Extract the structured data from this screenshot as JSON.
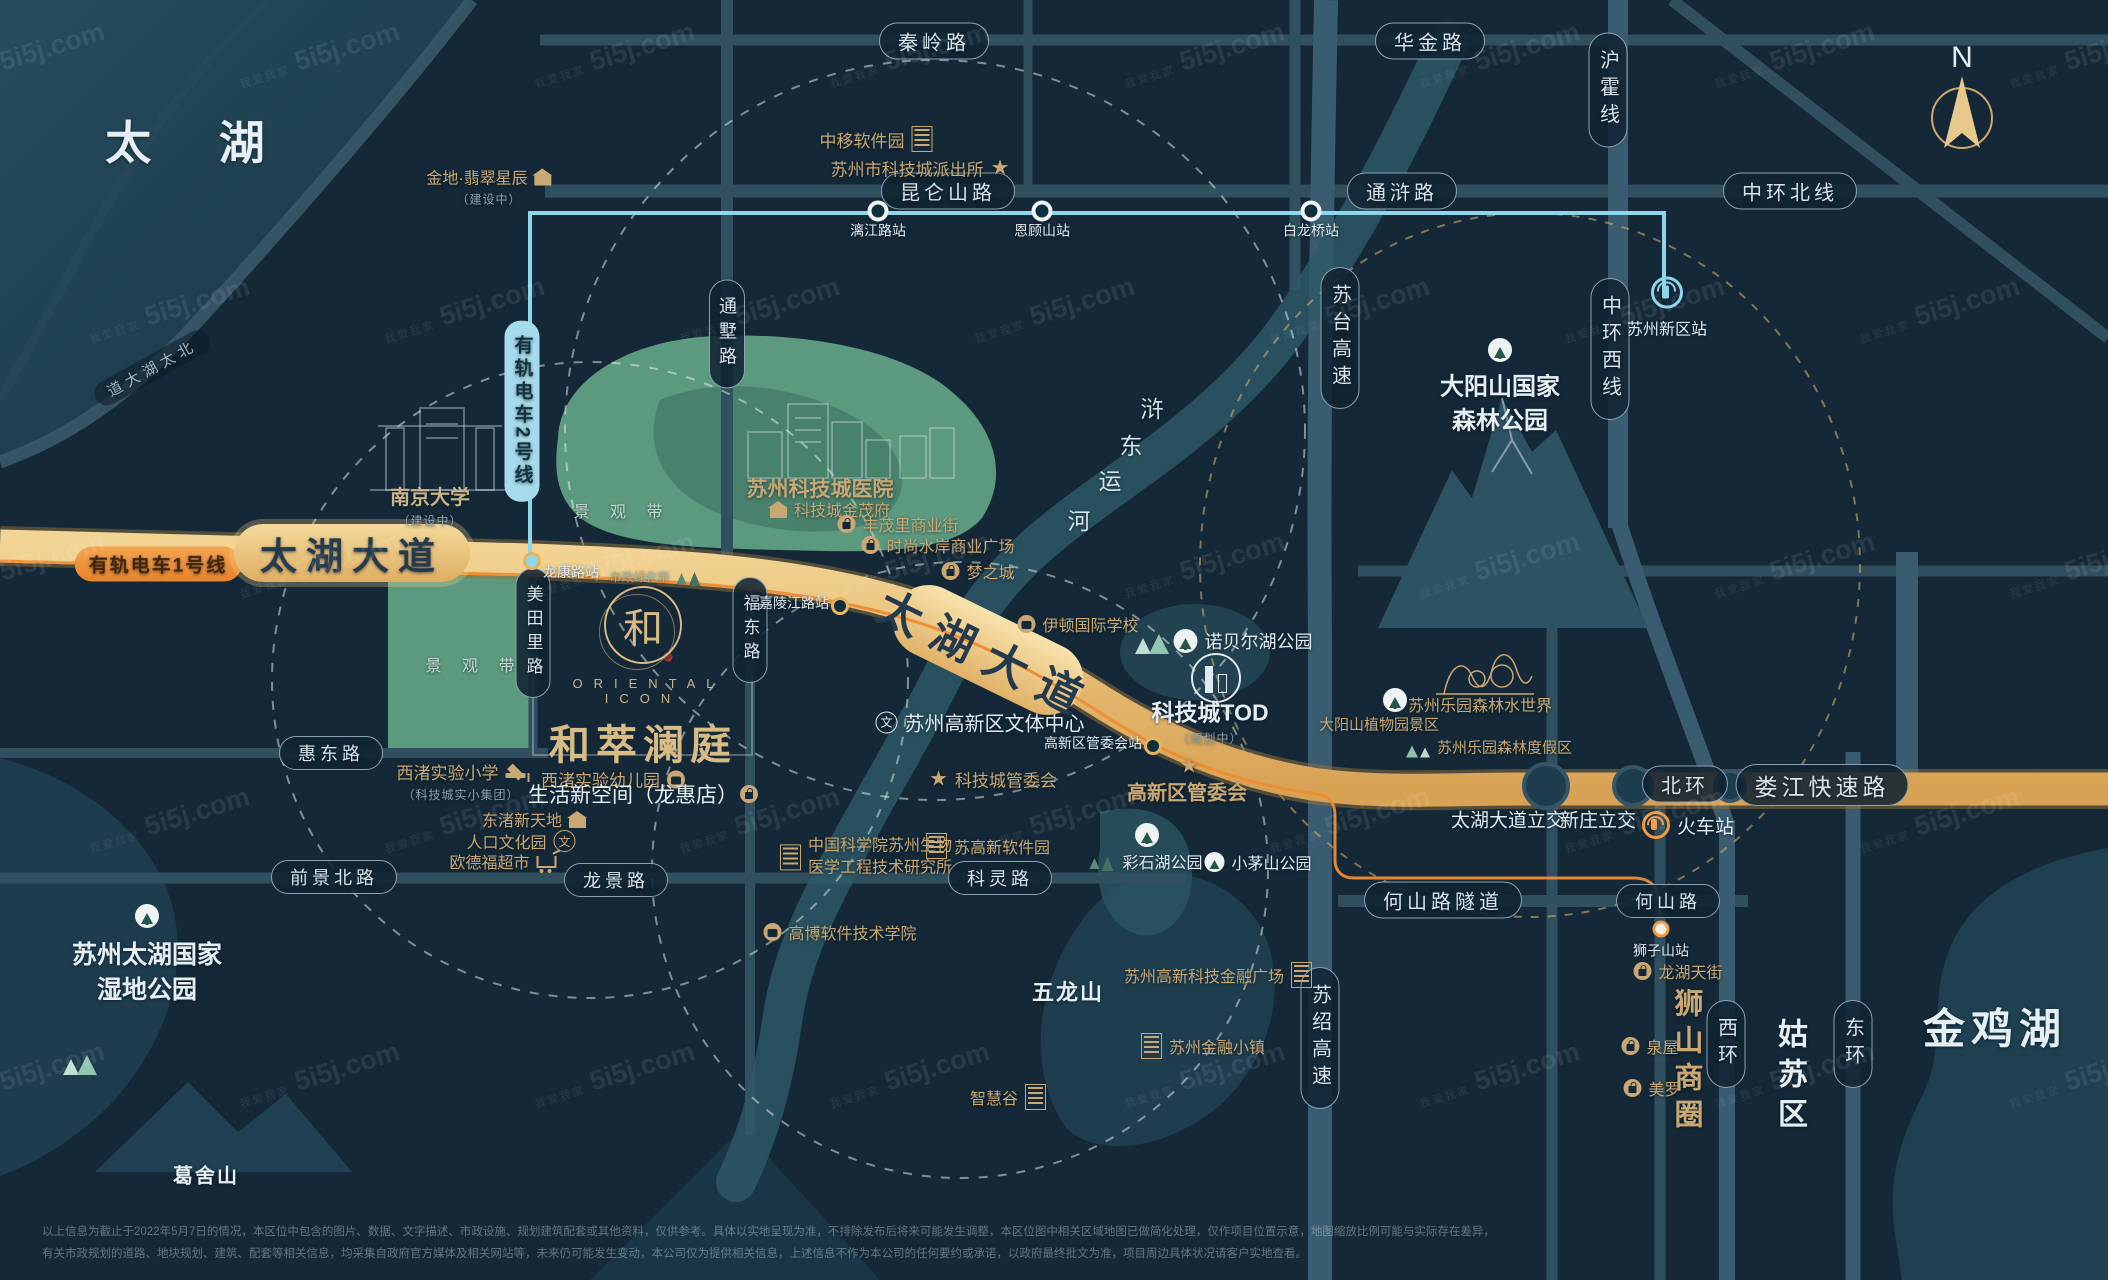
{
  "watermark": {
    "brand": "5i5j.com",
    "sub": "我爱我家"
  },
  "compass": {
    "n": "N"
  },
  "logo": {
    "mark": "和",
    "en": "ORIENTAL ICON",
    "name": "和萃澜庭",
    "tagline": "生活新空间（龙惠店）"
  },
  "disclaimer": {
    "line1": "以上信息为截止于2022年5月7日的情况，本区位中包含的图片、数据、文字描述、市政设施、规划建筑配套或其他资料，仅供参考。具体以实地呈现为准，不排除发布后将来可能发生调整，本区位图中相关区域地图已做简化处理，仅作项目位置示意，地图缩放比例可能与实际存在差异，",
    "line2": "有关市政规划的道路、地块规划、建筑、配套等相关信息，均采集自政府官方媒体及相关网站等，未来仍可能发生变动，本公司仅为提供相关信息，上述信息不作为本公司的任何要约或承诺，以政府最终批文为准，项目周边具体状况请客户实地查看。"
  },
  "labels": [
    {
      "name": "area-taihu",
      "type": "area",
      "text": "太  湖",
      "x": 192,
      "y": 140,
      "size": 46,
      "ls": 14
    },
    {
      "name": "area-jinjihu",
      "type": "area",
      "text": "金鸡湖",
      "x": 1995,
      "y": 1026,
      "size": 42,
      "ls": 6
    },
    {
      "name": "area-gusu",
      "type": "area-v",
      "text": "姑苏区",
      "x": 1789,
      "y": 1078,
      "size": 30,
      "ls": 10,
      "vert": true
    },
    {
      "name": "area-wetland",
      "type": "area-ml",
      "text": "苏州太湖国家\n湿地公园",
      "x": 147,
      "y": 973,
      "size": 25
    },
    {
      "name": "area-dayangshan",
      "type": "area-ml",
      "text": "大阳山国家\n森林公园",
      "x": 1500,
      "y": 404,
      "size": 24
    },
    {
      "name": "area-gesheshan",
      "type": "area",
      "text": "葛舍山",
      "x": 206,
      "y": 1174,
      "size": 20,
      "ls": 2
    },
    {
      "name": "area-wulongshan",
      "type": "area",
      "text": "五龙山",
      "x": 1068,
      "y": 991,
      "size": 22,
      "ls": 2
    },
    {
      "name": "canal-char-1",
      "type": "char",
      "text": "浒",
      "x": 1152,
      "y": 407,
      "size": 23
    },
    {
      "name": "canal-char-2",
      "type": "char",
      "text": "东",
      "x": 1131,
      "y": 444,
      "size": 23
    },
    {
      "name": "canal-char-3",
      "type": "char",
      "text": "运",
      "x": 1110,
      "y": 479,
      "size": 23
    },
    {
      "name": "canal-char-4",
      "type": "char",
      "text": "河",
      "x": 1079,
      "y": 519,
      "size": 23
    },
    {
      "name": "belt-upper",
      "type": "belt",
      "text": "景 观 带",
      "x": 622,
      "y": 510
    },
    {
      "name": "belt-lower",
      "type": "belt",
      "text": "景 观 带",
      "x": 474,
      "y": 664
    },
    {
      "name": "municipal-green-belt",
      "type": "poi",
      "text": "市政绿化带",
      "x": 656,
      "y": 576,
      "size": 12,
      "color": "teal",
      "icon": "trees-dark",
      "iconSide": "right"
    },
    {
      "name": "north-taihu-avenue",
      "type": "shorepill",
      "text": "道大湖太北",
      "x": 152,
      "y": 368,
      "rotate": -29
    },
    {
      "name": "pill-qinling-road",
      "type": "pill",
      "text": "秦岭路",
      "x": 934,
      "y": 41
    },
    {
      "name": "pill-huajin-road",
      "type": "pill",
      "text": "华金路",
      "x": 1430,
      "y": 41
    },
    {
      "name": "pill-kunlunshan-road",
      "type": "pill",
      "text": "昆仑山路",
      "x": 948,
      "y": 191
    },
    {
      "name": "pill-tonghu-road",
      "type": "pill",
      "text": "通浒路",
      "x": 1402,
      "y": 191
    },
    {
      "name": "pill-zhonghuan-north",
      "type": "pill",
      "text": "中环北线",
      "x": 1790,
      "y": 191
    },
    {
      "name": "pill-huidong-road",
      "type": "pill",
      "text": "惠东路",
      "x": 331,
      "y": 753,
      "size": 18
    },
    {
      "name": "pill-qianjing-north-road",
      "type": "pill",
      "text": "前景北路",
      "x": 334,
      "y": 877,
      "size": 18
    },
    {
      "name": "pill-longjing-road",
      "type": "pill",
      "text": "龙景路",
      "x": 616,
      "y": 880,
      "size": 18
    },
    {
      "name": "pill-keling-road",
      "type": "pill",
      "text": "科灵路",
      "x": 1000,
      "y": 878,
      "size": 18
    },
    {
      "name": "pill-heshan-tunnel",
      "type": "pill",
      "text": "何山路隧道",
      "x": 1443,
      "y": 900
    },
    {
      "name": "pill-heshan-road",
      "type": "pill",
      "text": "何山路",
      "x": 1668,
      "y": 901,
      "size": 18
    },
    {
      "name": "pill-beihuan",
      "type": "pill",
      "text": "北环",
      "x": 1685,
      "y": 784
    },
    {
      "name": "pill-loujiang-expressway",
      "type": "pill",
      "text": "娄江快速路",
      "x": 1822,
      "y": 785,
      "size": 23
    },
    {
      "name": "pill-huhuo-line",
      "type": "pill-v",
      "text": "沪霍线",
      "x": 1608,
      "y": 90
    },
    {
      "name": "pill-zhonghuan-west",
      "type": "pill-v",
      "text": "中环西线",
      "x": 1610,
      "y": 349
    },
    {
      "name": "pill-sutai-expressway",
      "type": "pill-v",
      "text": "苏台高速",
      "x": 1340,
      "y": 338
    },
    {
      "name": "pill-sushao-expressway",
      "type": "pill-v",
      "text": "苏绍高速",
      "x": 1320,
      "y": 1038
    },
    {
      "name": "pill-tongshu-road",
      "type": "pill-v",
      "text": "通墅路",
      "x": 727,
      "y": 334,
      "size": 18
    },
    {
      "name": "pill-meitianli-road",
      "type": "pill-v",
      "text": "美田里路",
      "x": 533,
      "y": 633,
      "size": 17
    },
    {
      "name": "pill-fudong-road",
      "type": "pill-v",
      "text": "福东路",
      "x": 750,
      "y": 630,
      "size": 17
    },
    {
      "name": "pill-xihuan",
      "type": "pill-v",
      "text": "西环",
      "x": 1726,
      "y": 1044
    },
    {
      "name": "pill-donghuan",
      "type": "pill-v",
      "text": "东环",
      "x": 1853,
      "y": 1044
    },
    {
      "name": "tram-line2-pill",
      "type": "tram2",
      "text": "有轨电车2号线",
      "x": 522,
      "y": 411
    },
    {
      "name": "tram-line1-pill",
      "type": "tram1",
      "text": "有轨电车1号线",
      "x": 158,
      "y": 564
    },
    {
      "name": "taihu-avenue-label-left",
      "type": "roadbig",
      "text": "太湖大道",
      "x": 352,
      "y": 553
    },
    {
      "name": "taihu-avenue-label-mid",
      "type": "roadbig2",
      "text": "太湖大道",
      "x": 988,
      "y": 652,
      "rotate": 26
    },
    {
      "name": "station-lijianglu",
      "type": "station",
      "text": "漓江路站",
      "x": 878,
      "y": 211,
      "labelSide": "below"
    },
    {
      "name": "station-engushan",
      "type": "station",
      "text": "恩顾山站",
      "x": 1042,
      "y": 211,
      "labelSide": "below"
    },
    {
      "name": "station-bailongqiao",
      "type": "station",
      "text": "白龙桥站",
      "x": 1311,
      "y": 211,
      "labelSide": "below"
    },
    {
      "name": "station-longkanglu",
      "type": "station-gold",
      "text": "龙康路站",
      "x": 532,
      "y": 561,
      "labelSide": "right",
      "dotbg": "#8ed6ea"
    },
    {
      "name": "station-jialingjianglu",
      "type": "station-gold",
      "text": "嘉陵江路站",
      "x": 840,
      "y": 606,
      "labelSide": "left"
    },
    {
      "name": "station-guanweihui",
      "type": "station-gold",
      "text": "高新区管委会站",
      "x": 1153,
      "y": 746,
      "labelSide": "left"
    },
    {
      "name": "station-shizishan",
      "type": "station-orange",
      "text": "狮子山站",
      "x": 1661,
      "y": 929,
      "labelSide": "below"
    },
    {
      "name": "station-xinqu",
      "type": "poi-col",
      "text": "苏州新区站",
      "x": 1667,
      "y": 308,
      "size": 16,
      "color": "white",
      "icon": "metro",
      "iconColor": "#8ed6ea"
    },
    {
      "name": "poi-jindi",
      "type": "poi",
      "text": "金地·翡翠星辰",
      "x": 489,
      "y": 186,
      "size": 16,
      "icon": "house",
      "iconSide": "right",
      "sub": "（建设中）"
    },
    {
      "name": "poi-zhongyi-software-park",
      "type": "poi",
      "text": "中移软件园",
      "x": 876,
      "y": 139,
      "icon": "bld",
      "iconSide": "right"
    },
    {
      "name": "poi-paichusuo",
      "type": "poi",
      "text": "苏州市科技城派出所",
      "x": 920,
      "y": 168,
      "icon": "star",
      "iconSide": "right"
    },
    {
      "name": "poi-nanjing-university",
      "type": "poi",
      "text": "南京大学",
      "x": 430,
      "y": 505,
      "size": 20,
      "color": "tan",
      "bold": true,
      "sub": "（建设中）"
    },
    {
      "name": "poi-kejicheng-hospital",
      "type": "poi",
      "text": "苏州科技城医院",
      "x": 820,
      "y": 488,
      "size": 21,
      "bold": true
    },
    {
      "name": "poi-jinmaofu",
      "type": "poi",
      "text": "科技城金茂府",
      "x": 830,
      "y": 509,
      "size": 16,
      "icon": "house",
      "iconSide": "left"
    },
    {
      "name": "poi-fengmaoli",
      "type": "poi",
      "text": "丰茂里商业街",
      "x": 898,
      "y": 524,
      "size": 16,
      "icon": "bag",
      "iconSide": "left"
    },
    {
      "name": "poi-shishang-shuian",
      "type": "poi",
      "text": "时尚水岸商业广场",
      "x": 938,
      "y": 545,
      "size": 16,
      "icon": "bag",
      "iconSide": "left"
    },
    {
      "name": "poi-mengzhicheng",
      "type": "poi",
      "text": "梦之城",
      "x": 978,
      "y": 571,
      "size": 16,
      "icon": "bag",
      "iconSide": "left"
    },
    {
      "name": "poi-yidun-school",
      "type": "poi",
      "text": "伊顿国际学校",
      "x": 1078,
      "y": 624,
      "size": 16,
      "icon": "badge",
      "iconSide": "left"
    },
    {
      "name": "deco-nobel-trees",
      "type": "icon",
      "x": 1152,
      "y": 641,
      "icon": "trees"
    },
    {
      "name": "poi-nobel-lake-park",
      "type": "poi",
      "text": "诺贝尔湖公园",
      "x": 1243,
      "y": 641,
      "size": 18,
      "color": "white",
      "icon": "treec",
      "iconSide": "left"
    },
    {
      "name": "poi-tod-icon",
      "type": "icon",
      "x": 1216,
      "y": 678,
      "icon": "tod"
    },
    {
      "name": "poi-kejicheng-tod",
      "type": "poi",
      "text": "科技城TOD",
      "x": 1210,
      "y": 720,
      "size": 23,
      "color": "white",
      "bold": true,
      "sub": "（规划中）"
    },
    {
      "name": "poi-wenti-center",
      "type": "poi",
      "text": "苏州高新区文体中心",
      "x": 980,
      "y": 722,
      "size": 20,
      "color": "white",
      "icon": "wen",
      "iconSide": "left"
    },
    {
      "name": "poi-kejicheng-guanweihui",
      "type": "poi",
      "text": "科技城管委会",
      "x": 993,
      "y": 779,
      "icon": "star",
      "iconSide": "left"
    },
    {
      "name": "poi-gaoxin-guanweihui-star",
      "type": "icon",
      "x": 1189,
      "y": 766,
      "icon": "star"
    },
    {
      "name": "poi-gaoxin-guanweihui",
      "type": "poi",
      "text": "高新区管委会",
      "x": 1187,
      "y": 791,
      "size": 20,
      "bold": true
    },
    {
      "name": "poi-xizhu-primary-school",
      "type": "poi",
      "text": "西渚实验小学",
      "x": 461,
      "y": 781,
      "icon": "cap",
      "iconSide": "right",
      "sub": "（科技城实小集团）"
    },
    {
      "name": "poi-xizhu-kindergarten",
      "type": "poi",
      "text": "西渚实验幼儿园",
      "x": 613,
      "y": 779,
      "icon": "badge",
      "iconSide": "right"
    },
    {
      "name": "poi-dongzhu-xintiandi",
      "type": "poi",
      "text": "东渚新天地",
      "x": 534,
      "y": 819,
      "size": 16,
      "icon": "house",
      "iconSide": "right"
    },
    {
      "name": "poi-renkou-wenhuayuan",
      "type": "poi",
      "text": "人口文化园",
      "x": 521,
      "y": 841,
      "size": 16,
      "icon": "wen",
      "iconSide": "right"
    },
    {
      "name": "poi-oudefu-market",
      "type": "poi",
      "text": "欧德福超市",
      "x": 503,
      "y": 861,
      "size": 16,
      "icon": "cart",
      "iconSide": "right"
    },
    {
      "name": "poi-zhongkeyuan",
      "type": "poi",
      "text": "中国科学院苏州生物\n医学工程技术研究所",
      "x": 866,
      "y": 857,
      "size": 16,
      "icon": "bld",
      "iconSide": "left",
      "ml": true
    },
    {
      "name": "poi-sugaoxin-software-park",
      "type": "poi",
      "text": "苏高新软件园",
      "x": 988,
      "y": 846,
      "size": 16,
      "icon": "bld",
      "iconSide": "left"
    },
    {
      "name": "poi-gaobo-college",
      "type": "poi",
      "text": "高博软件技术学院",
      "x": 840,
      "y": 932,
      "size": 16,
      "icon": "badge",
      "iconSide": "left"
    },
    {
      "name": "deco-caishihu-treec",
      "type": "icon",
      "x": 1147,
      "y": 835,
      "icon": "treec"
    },
    {
      "name": "poi-caishihu-park",
      "type": "poi",
      "text": "彩石湖公园",
      "x": 1146,
      "y": 861,
      "size": 16,
      "color": "white",
      "icon": "trees-dark",
      "iconSide": "left"
    },
    {
      "name": "poi-xiaomaoshan-park",
      "type": "poi",
      "text": "小茅山公园",
      "x": 1258,
      "y": 862,
      "size": 16,
      "color": "white",
      "icon": "treec-sm",
      "iconSide": "left"
    },
    {
      "name": "poi-keji-jinrong-plaza",
      "type": "poi",
      "text": "苏州高新科技金融广场",
      "x": 1218,
      "y": 975,
      "size": 16,
      "icon": "bld",
      "iconSide": "right"
    },
    {
      "name": "poi-jinrong-town",
      "type": "poi",
      "text": "苏州金融小镇",
      "x": 1203,
      "y": 1046,
      "size": 16,
      "icon": "bld",
      "iconSide": "left"
    },
    {
      "name": "poi-zhihuigu",
      "type": "poi",
      "text": "智慧谷",
      "x": 1008,
      "y": 1097,
      "size": 16,
      "icon": "bld",
      "iconSide": "right"
    },
    {
      "name": "poi-forest-water-world",
      "type": "poi",
      "text": "苏州乐园森林水世界",
      "x": 1480,
      "y": 704,
      "size": 16
    },
    {
      "name": "deco-zhiwuyuan-treec",
      "type": "icon",
      "x": 1395,
      "y": 700,
      "icon": "treec"
    },
    {
      "name": "poi-dayangshan-botanic",
      "type": "poi",
      "text": "大阳山植物园景区",
      "x": 1379,
      "y": 724,
      "size": 15
    },
    {
      "name": "poi-forest-resort",
      "type": "poi",
      "text": "苏州乐园森林度假区",
      "x": 1488,
      "y": 747,
      "size": 15,
      "icon": "palms",
      "iconSide": "left"
    },
    {
      "name": "label-taihu-interchange",
      "type": "poi",
      "text": "太湖大道立交",
      "x": 1508,
      "y": 819,
      "size": 19,
      "color": "white"
    },
    {
      "name": "label-xinzhuang-interchange",
      "type": "poi",
      "text": "新庄立交",
      "x": 1598,
      "y": 819,
      "size": 19,
      "color": "white"
    },
    {
      "name": "poi-railway-station",
      "type": "poi",
      "text": "火车站",
      "x": 1688,
      "y": 825,
      "size": 19,
      "color": "white",
      "icon": "rail",
      "iconSide": "left",
      "iconColor": "#f09a42"
    },
    {
      "name": "poi-longhu-tianjie",
      "type": "poi",
      "text": "龙湖天街",
      "x": 1678,
      "y": 971,
      "size": 16,
      "icon": "bag",
      "iconSide": "left"
    },
    {
      "name": "poi-quanwu",
      "type": "poi",
      "text": "泉屋",
      "x": 1650,
      "y": 1046,
      "size": 16,
      "icon": "bag",
      "iconSide": "left"
    },
    {
      "name": "poi-meiluo",
      "type": "poi",
      "text": "美罗",
      "x": 1652,
      "y": 1088,
      "size": 16,
      "icon": "bag",
      "iconSide": "left"
    },
    {
      "name": "label-shishan-shangquan",
      "type": "area-v",
      "text": "狮山商圈",
      "x": 1686,
      "y": 1062,
      "size": 29,
      "ls": 8,
      "color": "gold",
      "vert": true,
      "bold": true
    },
    {
      "name": "deco-wetland-trees",
      "type": "icon",
      "x": 80,
      "y": 1062,
      "icon": "trees"
    },
    {
      "name": "deco-wetland-treec",
      "type": "icon",
      "x": 147,
      "y": 916,
      "icon": "treec"
    },
    {
      "name": "deco-dayangshan-treec",
      "type": "icon",
      "x": 1500,
      "y": 350,
      "icon": "treec"
    }
  ]
}
